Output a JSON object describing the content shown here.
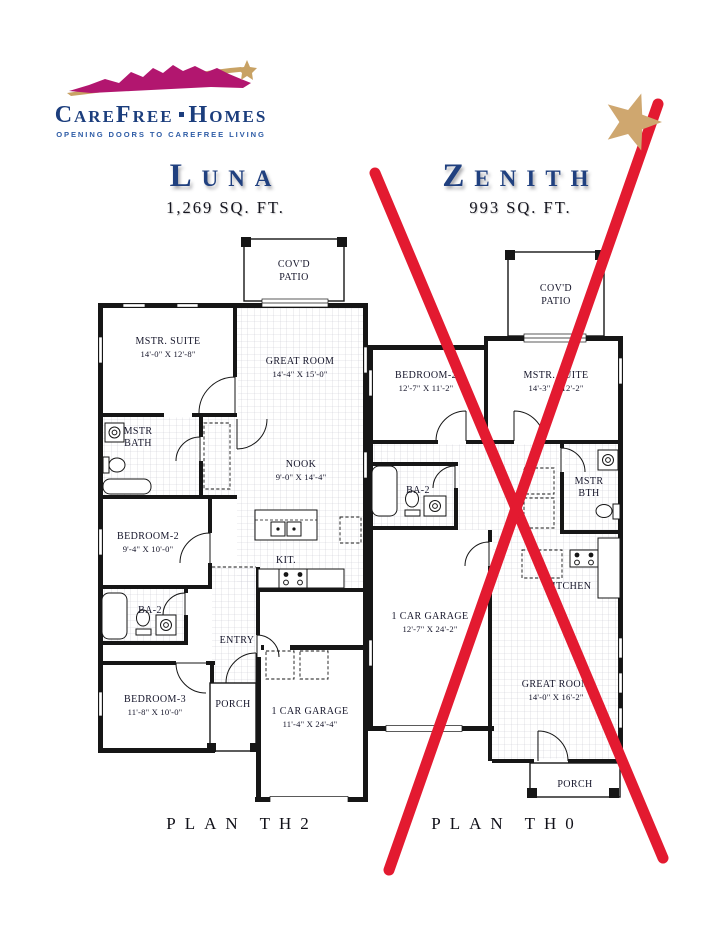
{
  "page": {
    "background": "#ffffff"
  },
  "logo": {
    "brand_word1": "CareFree",
    "brand_word2": "Homes",
    "tagline": "OPENING DOORS TO CAREFREE LIVING",
    "colors": {
      "navy": "#1c3e7d",
      "magenta": "#b2166f",
      "gold": "#c8a264",
      "tagline_blue": "#2e5ca6"
    }
  },
  "plans": [
    {
      "id": "luna",
      "title": "Luna",
      "sqft": "1,269 SQ. FT.",
      "plan_label": "PLAN TH2",
      "crossed_out": false,
      "rooms": [
        {
          "name": "covd-patio",
          "lines": [
            "COV'D",
            "PATIO"
          ]
        },
        {
          "name": "mstr-suite",
          "lines": [
            "MSTR. SUITE",
            "14'-0\" X 12'-8\""
          ]
        },
        {
          "name": "great-room",
          "lines": [
            "GREAT ROOM",
            "14'-4\" X 15'-0\""
          ]
        },
        {
          "name": "mstr-bath",
          "lines": [
            "MSTR",
            "BATH"
          ]
        },
        {
          "name": "nook",
          "lines": [
            "NOOK",
            "9'-0\" X 14'-4\""
          ]
        },
        {
          "name": "bedroom-2",
          "lines": [
            "BEDROOM-2",
            "9'-4\" X 10'-0\""
          ]
        },
        {
          "name": "kitchen",
          "lines": [
            "KIT."
          ]
        },
        {
          "name": "bath-2",
          "lines": [
            "BA-2"
          ]
        },
        {
          "name": "entry",
          "lines": [
            "ENTRY"
          ]
        },
        {
          "name": "bedroom-3",
          "lines": [
            "BEDROOM-3",
            "11'-8\" X 10'-0\""
          ]
        },
        {
          "name": "porch",
          "lines": [
            "PORCH"
          ]
        },
        {
          "name": "garage",
          "lines": [
            "1 CAR GARAGE",
            "11'-4\" X 24'-4\""
          ]
        }
      ]
    },
    {
      "id": "zenith",
      "title": "Zenith",
      "sqft": "993 SQ. FT.",
      "plan_label": "PLAN TH0",
      "crossed_out": true,
      "rooms": [
        {
          "name": "covd-patio",
          "lines": [
            "COV'D",
            "PATIO"
          ]
        },
        {
          "name": "bedroom-2",
          "lines": [
            "BEDROOM-2",
            "12'-7\" X 11'-2\""
          ]
        },
        {
          "name": "mstr-suite",
          "lines": [
            "MSTR. SUITE",
            "14'-3\" X 12'-2\""
          ]
        },
        {
          "name": "bath-2",
          "lines": [
            "BA-2"
          ]
        },
        {
          "name": "mstr-bath",
          "lines": [
            "MSTR",
            "BTH"
          ]
        },
        {
          "name": "kitchen",
          "lines": [
            "KITCHEN"
          ]
        },
        {
          "name": "garage",
          "lines": [
            "1 CAR GARAGE",
            "12'-7\" X 24'-2\""
          ]
        },
        {
          "name": "great-room",
          "lines": [
            "GREAT ROOM",
            "14'-0\" X 16'-2\""
          ]
        },
        {
          "name": "porch",
          "lines": [
            "PORCH"
          ]
        }
      ]
    }
  ],
  "annotations": {
    "cross_color": "#e31a30",
    "star_color": "#cfa76f"
  }
}
